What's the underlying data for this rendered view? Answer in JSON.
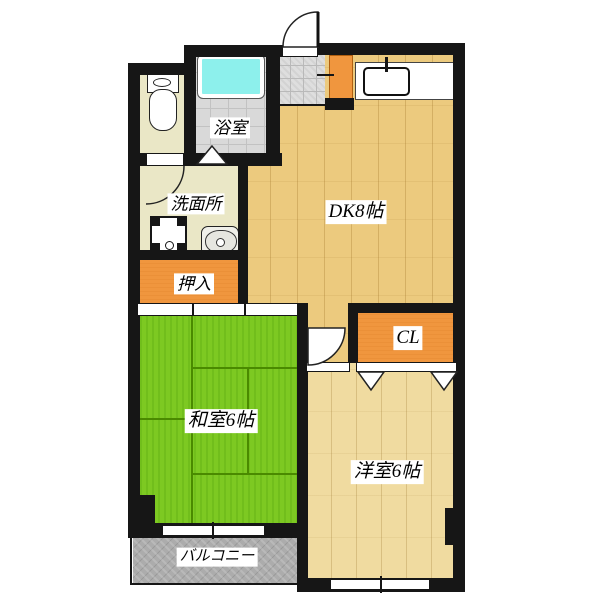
{
  "plan_title": "apartment-floor-plan",
  "rooms": {
    "bathroom": {
      "label": "浴室"
    },
    "washroom": {
      "label": "洗面所"
    },
    "oshiire_closet": {
      "label": "押入"
    },
    "dining_kitchen": {
      "label": "DK8帖"
    },
    "cl_closet": {
      "label": "CL"
    },
    "japanese_room": {
      "label": "和室6帖"
    },
    "western_room": {
      "label": "洋室6帖"
    },
    "balcony": {
      "label": "バルコニー"
    }
  },
  "colors": {
    "wall_black": "#161616",
    "tatami_green": "#7dc922",
    "dk_wood": "#ecca7e",
    "western_wood": "#f0dba0",
    "closet_orange": "#f0963e",
    "bathtub_cyan": "#8df0ec",
    "balcony_gray": "#acacac",
    "washroom_cream": "#eae7c6"
  }
}
